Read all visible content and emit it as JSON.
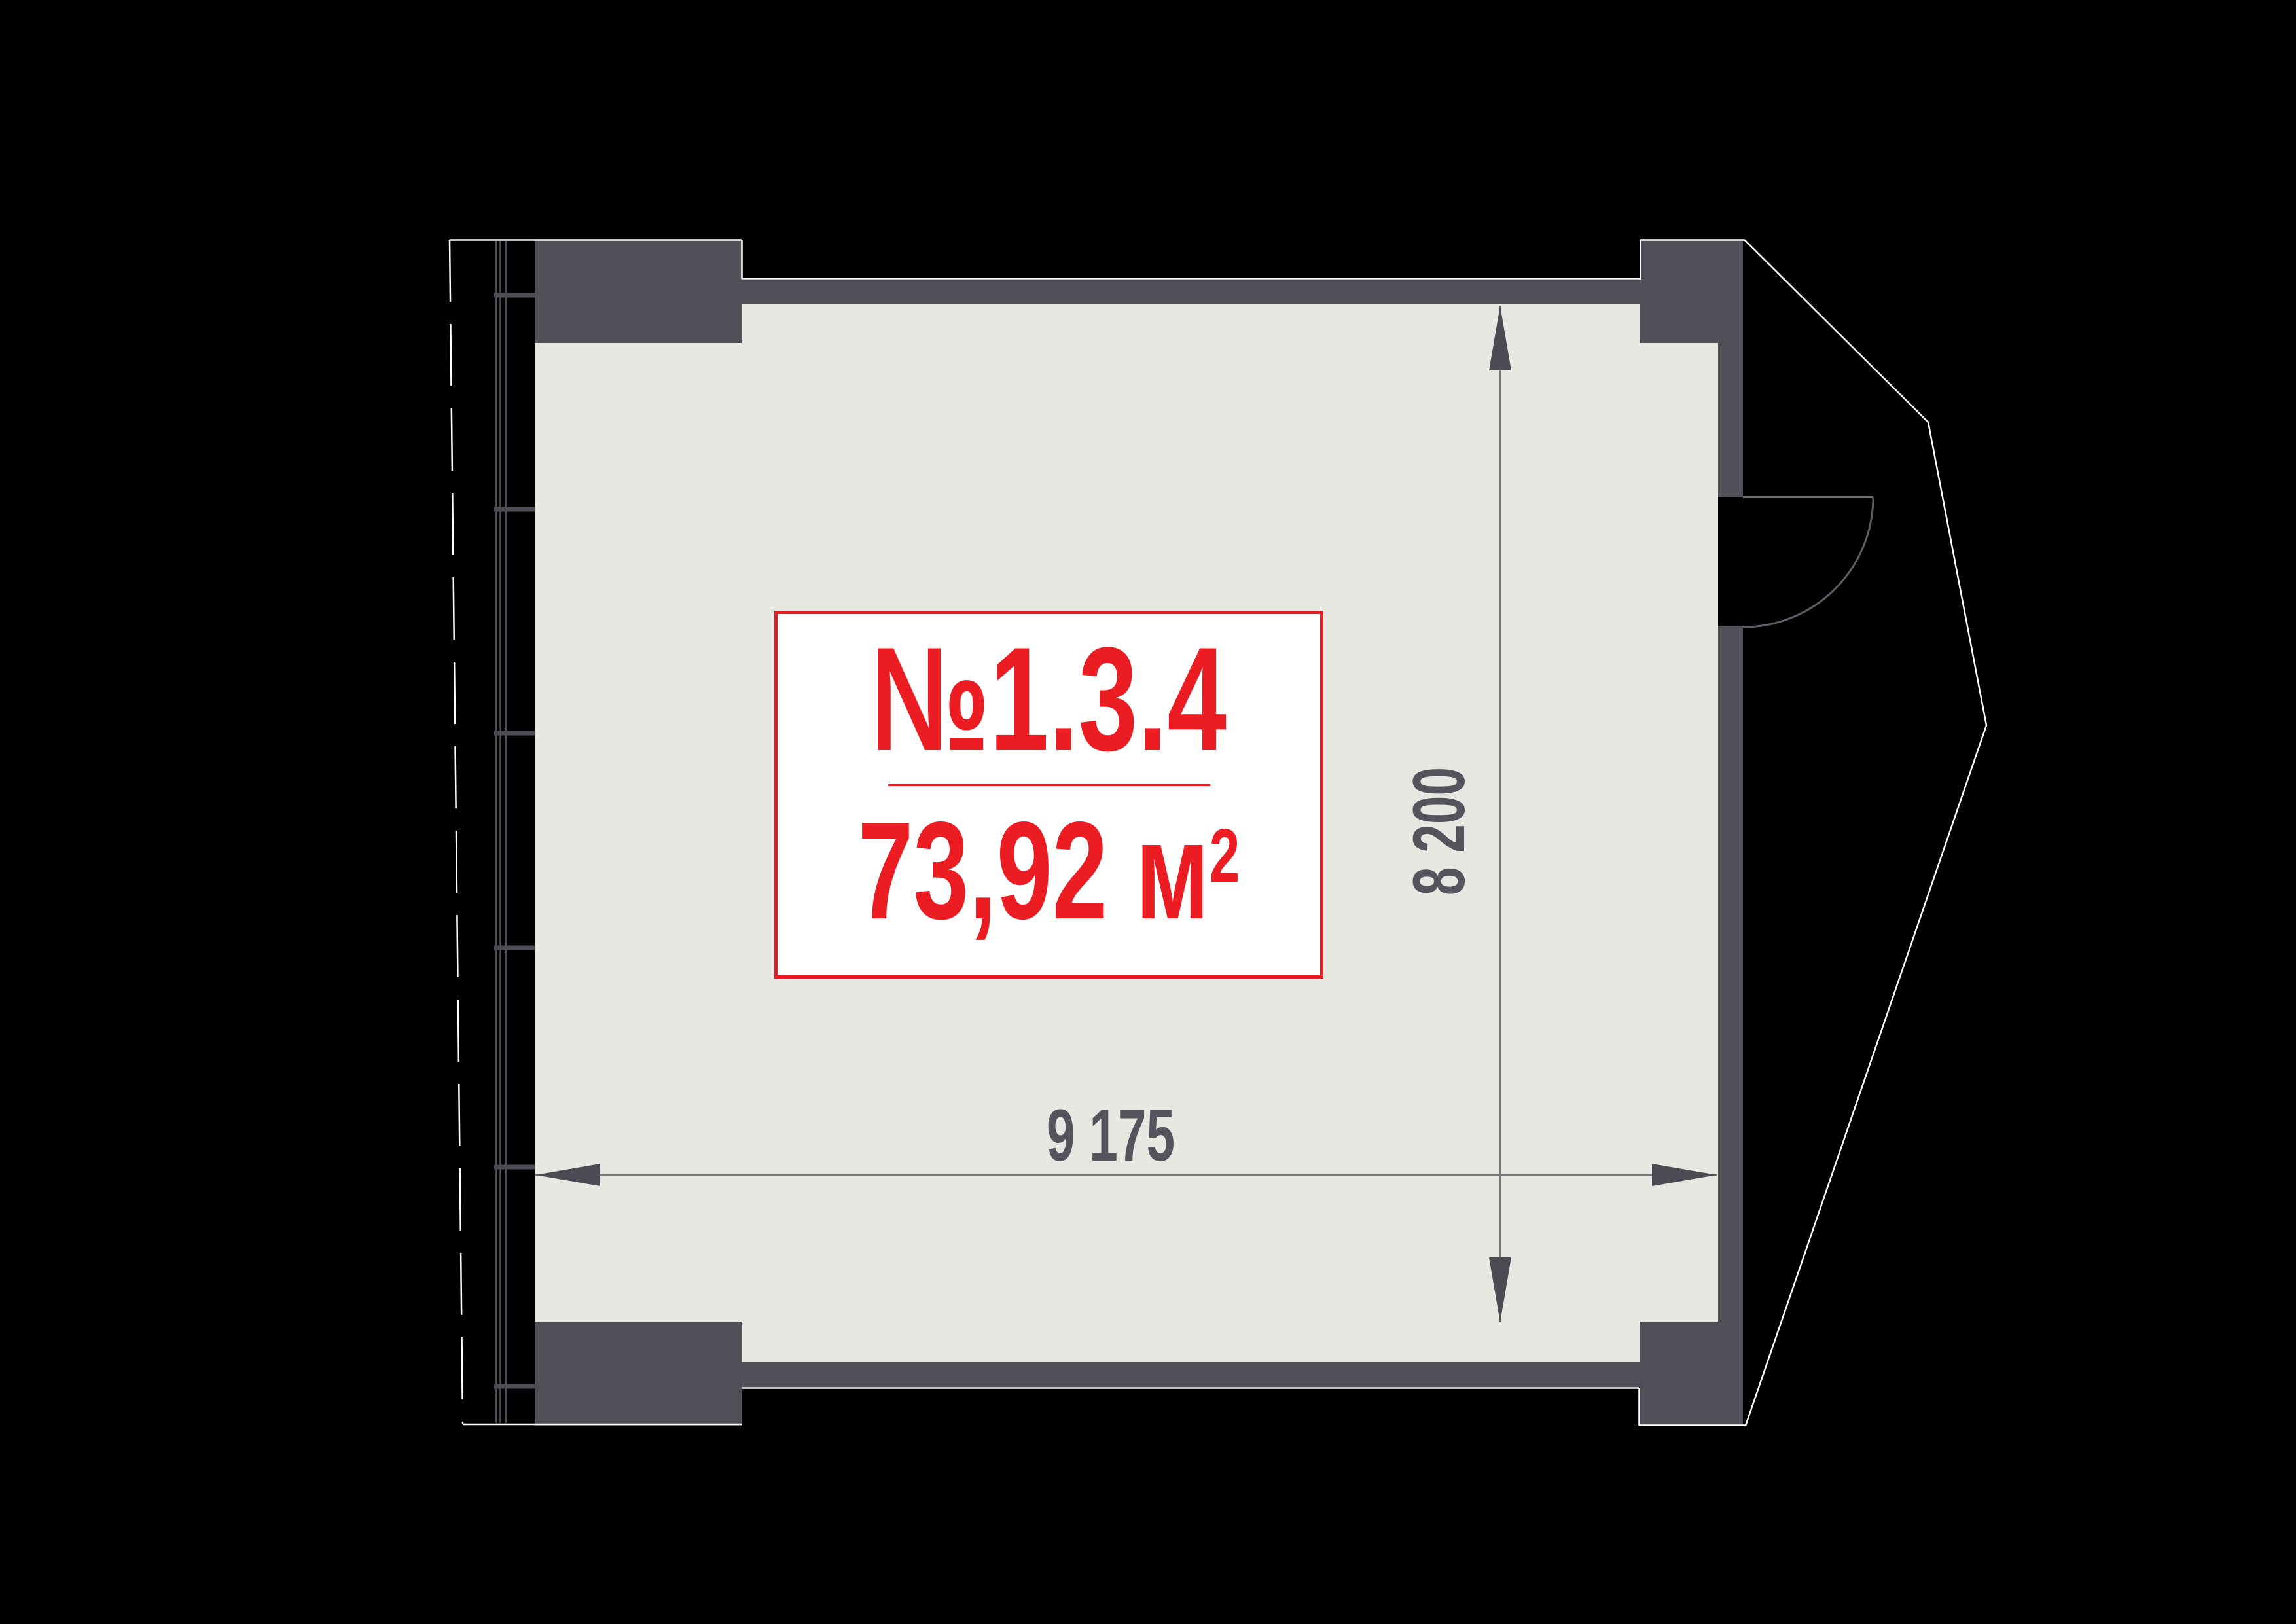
{
  "unit_label": {
    "number": "№1.3.4",
    "area_value": "73,92 м",
    "area_superscript": "2"
  },
  "dimensions": {
    "width_label": "9 175",
    "height_label": "8 200"
  },
  "colors": {
    "background": "#000000",
    "floor": "#e7e8e2",
    "wall": "#4f5057",
    "outline": "#ffffff",
    "accent_red": "#ec1c23",
    "dim_text": "#54555c",
    "dim_line": "#77787c",
    "dim_arrow": "#4b4c53",
    "door_leaf": "#6f7074",
    "door_arc": "#5d5e64",
    "window_line": "#4d4e55"
  }
}
